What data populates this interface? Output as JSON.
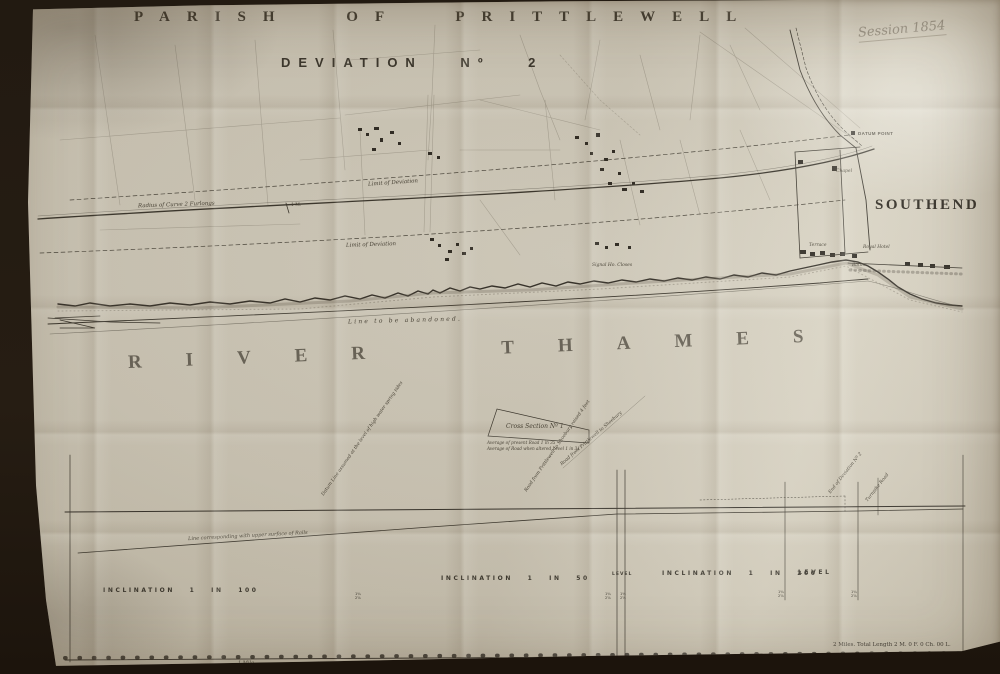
{
  "sheet": {
    "title": "PARISH OF PRITTLEWELL",
    "subtitle": "DEVIATION Nº 2",
    "handwritten_note": "Session 1854",
    "footer": "2 Miles. Total Length 2 M. 0 F. 0 Ch. 00 L."
  },
  "map": {
    "labels": {
      "radius_of_curve": "Radius of Curve 2 Furlongs",
      "limit_of_deviation_upper": "Limit of Deviation",
      "limit_of_deviation_lower": "Limit of Deviation",
      "mile_post": "1 M.",
      "signal_closes": "Signal Ho. Closes",
      "datum_point": "DATUM POINT",
      "southend": "SOUTHEND",
      "chapel": "Chapel",
      "terrace": "Terrace",
      "royal_hotel": "Royal Hotel",
      "baths": "Baths",
      "line_abandoned": "Line to be abandoned.",
      "river": "RIVER THAMES"
    },
    "cross_section": {
      "title": "Cross Section Nº 1",
      "note1": "Average of present Road 1 in 35",
      "note2": "Average of Road when altered Level 1 in 31",
      "road_note": "Road from Prittlewell to Shoebury"
    }
  },
  "section": {
    "rail_note": "Line corresponding with upper surface of Rails",
    "datum_note": "Datum Line assumed at the level of high water spring tides",
    "road_note": "Road from Prittlewell to Shoebury raised 4 feet",
    "end_note": "End of Deviation Nº 2",
    "turnpike_note": "Turnpike Road",
    "post_top": "1¾",
    "post_bottom": "2⅝",
    "gradients": [
      {
        "label": "INCLINATION 1 IN 100"
      },
      {
        "label": "INCLINATION 1 IN 50"
      },
      {
        "label": "LEVEL"
      },
      {
        "label": "INCLINATION 1 IN 200"
      },
      {
        "label": "LEVEL"
      }
    ],
    "scale_label": "1 Mile"
  }
}
